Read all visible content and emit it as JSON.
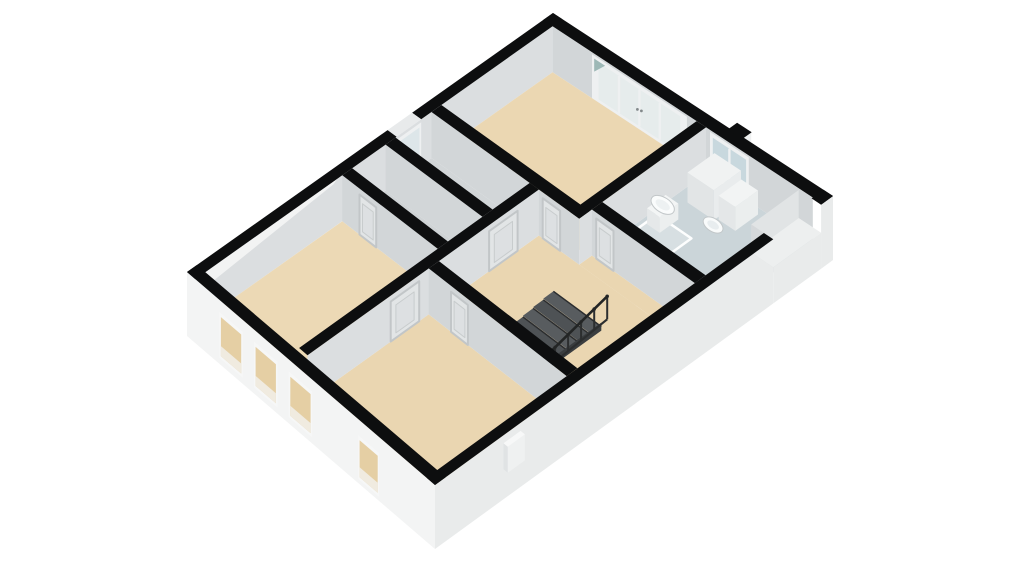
{
  "page": {
    "background": "#ffffff"
  },
  "scene": {
    "description_name": "3d-floorplan-upper-floor",
    "projection": {
      "n": [
        553,
        13
      ],
      "e": [
        833,
        196
      ],
      "s": [
        435,
        485
      ],
      "w": [
        187,
        272
      ]
    },
    "palette": {
      "wall_top": "#0d0e0f",
      "floor_beige": "#ebd7b2",
      "floor_gray": "#d2d6d8",
      "bath_floor": "#cbd5d9",
      "facade_white": "#f3f4f4",
      "facade_shade": "#e9ebeb",
      "face_sw": "#d2d6d8",
      "face_se": "#dbdee0",
      "glass_blue": "#c8d8de",
      "window_beige": "#e5cfa4"
    },
    "elements": [
      {
        "t": "face",
        "name": "ne-wall-interior-face",
        "a": [
          0.034,
          0.027
        ],
        "b": [
          0.966,
          0.027
        ],
        "top": 0,
        "bot": 46,
        "fill": "#d2d6d8"
      },
      {
        "t": "win",
        "name": "bedroom-a-french-doors",
        "a": [
          0.175,
          0.027
        ],
        "b": [
          0.515,
          0.027
        ],
        "top": 2,
        "bot": 46,
        "frame": "#eef0f1",
        "glass": "#e6ecec",
        "panels": 4,
        "handles": true
      },
      {
        "t": "poly",
        "name": "door-glass-reflection",
        "pts": [
          [
            0.183,
            0.027,
            5
          ],
          [
            0.222,
            0.027,
            5
          ],
          [
            0.183,
            0.027,
            18
          ]
        ],
        "fill": "#9db8b6"
      },
      {
        "t": "win",
        "name": "bathroom-window",
        "a": [
          0.598,
          0.027
        ],
        "b": [
          0.737,
          0.027
        ],
        "top": 2,
        "bot": 46,
        "frame": "#eef0f1",
        "glass": "#c8d8de",
        "panels": 2
      },
      {
        "t": "face",
        "name": "nw-wall-interior-face",
        "a": [
          0.034,
          0.027
        ],
        "b": [
          0.034,
          0.973
        ],
        "top": 0,
        "bot": 46,
        "fill": "#dbdee0"
      },
      {
        "t": "win",
        "name": "closet-window",
        "a": [
          0.034,
          0.385
        ],
        "b": [
          0.034,
          0.452
        ],
        "top": 3,
        "bot": 42,
        "frame": "#eef0f1",
        "glass": "#dde6e9",
        "panels": 1
      },
      {
        "t": "floor",
        "name": "bedroom-a-floor",
        "r": [
          0.034,
          0.027,
          0.55,
          0.33
        ],
        "drop": 46,
        "fill": "#ebd7b2"
      },
      {
        "t": "floor",
        "name": "bathroom-floor",
        "r": [
          0.584,
          0.027,
          0.966,
          0.297
        ],
        "drop": 46,
        "fill": "#cbd5d9"
      },
      {
        "t": "panel",
        "name": "shower-area",
        "r": [
          0.602,
          0.168,
          0.728,
          0.284
        ],
        "drop": 45,
        "fill": "#d7dfe2",
        "stroke": "#fdfefe",
        "sw": 2.5
      },
      {
        "t": "floor",
        "name": "closet-1-floor",
        "r": [
          0.034,
          0.357,
          0.4,
          0.455
        ],
        "drop": 46,
        "fill": "#d2d6d8"
      },
      {
        "t": "floor",
        "name": "closet-2-floor",
        "r": [
          0.034,
          0.482,
          0.4,
          0.573
        ],
        "drop": 46,
        "fill": "#cfd3d5"
      },
      {
        "t": "floor",
        "name": "hallway-floor",
        "r": [
          0.434,
          0.357,
          0.966,
          0.62
        ],
        "drop": 46,
        "fill": "#ead6b1"
      },
      {
        "t": "floor",
        "name": "hallway-floor-annex",
        "r": [
          0.584,
          0.324,
          0.966,
          0.357
        ],
        "drop": 46,
        "fill": "#ead6b1"
      },
      {
        "t": "floor",
        "name": "bedroom-b-floor",
        "r": [
          0.034,
          0.6,
          0.4,
          0.966
        ],
        "drop": 46,
        "fill": "#ecd9b5"
      },
      {
        "t": "floor",
        "name": "bedroom-c-floor",
        "r": [
          0.434,
          0.647,
          0.966,
          0.966
        ],
        "drop": 46,
        "fill": "#ead6b1"
      },
      {
        "t": "face",
        "name": "bathroom-west-wall-face",
        "a": [
          0.584,
          0.027
        ],
        "b": [
          0.584,
          0.357
        ],
        "top": 0,
        "bot": 46,
        "fill": "#dbdee0"
      },
      {
        "t": "prism",
        "name": "bathroom-cabinet",
        "r": [
          0.625,
          0.035,
          0.72,
          0.105
        ],
        "top": 16,
        "bot": 46,
        "topFill": "#f0f2f2",
        "vFill": "#e2e5e6",
        "uFill": "#e9eced"
      },
      {
        "t": "prism",
        "name": "sink-pedestal",
        "r": [
          0.606,
          0.148,
          0.652,
          0.196
        ],
        "top": 30,
        "bot": 46,
        "topFill": "#f3f5f5",
        "vFill": "#e5e8e9",
        "uFill": "#ecefef"
      },
      {
        "t": "ell",
        "name": "sink-basin",
        "c": [
          0.629,
          0.172,
          29
        ],
        "rx": 13,
        "ry": 7.5,
        "rot": 33,
        "fill": "#fafcfc",
        "stroke": "#c2c7c9",
        "sw": 1,
        "irx": 8,
        "iry": 4.2,
        "ifill": "#edf1f2"
      },
      {
        "t": "prism",
        "name": "toilet-cistern",
        "r": [
          0.728,
          0.04,
          0.788,
          0.098
        ],
        "top": 22,
        "bot": 46,
        "topFill": "#f2f4f4",
        "vFill": "#e4e7e8",
        "uFill": "#ebeeee"
      },
      {
        "t": "ell",
        "name": "toilet-bowl",
        "c": [
          0.757,
          0.133,
          36
        ],
        "rx": 11,
        "ry": 6.5,
        "rot": 33,
        "fill": "#f9fbfb",
        "stroke": "#c2c7c9",
        "sw": 1,
        "irx": 6.5,
        "iry": 3.6,
        "ifill": "#e8edef"
      },
      {
        "t": "face",
        "name": "bathroom-hall-wall-face",
        "a": [
          0.584,
          0.324
        ],
        "b": [
          0.966,
          0.324
        ],
        "top": 0,
        "bot": 46,
        "fill": "#d2d6d8"
      },
      {
        "t": "door",
        "name": "bathroom-door",
        "a": [
          0.6,
          0.324
        ],
        "b": [
          0.664,
          0.324
        ],
        "top": 6,
        "bot": 46
      },
      {
        "t": "face",
        "name": "bedroom-a-south-wall-face",
        "a": [
          0.034,
          0.357
        ],
        "b": [
          0.584,
          0.357
        ],
        "top": 0,
        "bot": 46,
        "fill": "#d2d6d8"
      },
      {
        "t": "door",
        "name": "bedroom-a-door",
        "a": [
          0.448,
          0.357
        ],
        "b": [
          0.513,
          0.357
        ],
        "top": 6,
        "bot": 46
      },
      {
        "t": "face",
        "name": "closet-divider-face",
        "a": [
          0.034,
          0.482
        ],
        "b": [
          0.4,
          0.482
        ],
        "top": 0,
        "bot": 46,
        "fill": "#d2d6d8"
      },
      {
        "t": "face",
        "name": "closet-south-wall-face",
        "a": [
          0.034,
          0.6
        ],
        "b": [
          0.4,
          0.6
        ],
        "top": 0,
        "bot": 46,
        "fill": "#d2d6d8"
      },
      {
        "t": "door",
        "name": "closet-2-door",
        "a": [
          0.1,
          0.6
        ],
        "b": [
          0.164,
          0.6
        ],
        "top": 6,
        "bot": 46
      },
      {
        "t": "face",
        "name": "central-wall-face",
        "a": [
          0.434,
          0.357
        ],
        "b": [
          0.434,
          0.966
        ],
        "top": 0,
        "bot": 46,
        "fill": "#dbdee0"
      },
      {
        "t": "door",
        "name": "closet-hall-door",
        "a": [
          0.434,
          0.413
        ],
        "b": [
          0.434,
          0.488
        ],
        "top": 6,
        "bot": 46
      },
      {
        "t": "door",
        "name": "bedroom-b-door",
        "a": [
          0.434,
          0.672
        ],
        "b": [
          0.434,
          0.747
        ],
        "top": 6,
        "bot": 46
      },
      {
        "t": "stairs",
        "name": "staircase",
        "r": [
          0.6,
          0.435,
          0.78,
          0.62
        ],
        "steps": 7
      },
      {
        "t": "railing",
        "name": "stair-railing",
        "u": 0.78,
        "v0": 0.42,
        "v1": 0.62,
        "posts": 7
      },
      {
        "t": "face",
        "name": "bedroom-c-north-wall-face",
        "a": [
          0.434,
          0.647
        ],
        "b": [
          0.966,
          0.647
        ],
        "top": 0,
        "bot": 46,
        "fill": "#d2d6d8"
      },
      {
        "t": "door",
        "name": "bedroom-c-door",
        "a": [
          0.52,
          0.647
        ],
        "b": [
          0.585,
          0.647
        ],
        "top": 6,
        "bot": 46
      },
      {
        "t": "poly",
        "name": "west-corner-wall-sliver",
        "pts": [
          [
            0,
            0.55,
            3
          ],
          [
            0,
            1,
            2
          ],
          [
            0,
            1,
            30
          ],
          [
            0,
            0.6,
            16
          ]
        ],
        "fill": "#f2f3f3"
      },
      {
        "t": "face",
        "name": "southwest-facade",
        "a": [
          0,
          1
        ],
        "b": [
          1,
          1
        ],
        "top": 0,
        "bot": 64,
        "fill": "#f3f4f4"
      },
      {
        "t": "win",
        "name": "facade-window-1",
        "a": [
          0.13,
          1
        ],
        "b": [
          0.225,
          1
        ],
        "top": 12,
        "bot": 58,
        "frame": "#f6f7f7",
        "glass": "#e5cfa4",
        "panels": 1,
        "lower": true
      },
      {
        "t": "win",
        "name": "facade-window-2",
        "a": [
          0.27,
          1
        ],
        "b": [
          0.365,
          1
        ],
        "top": 12,
        "bot": 58,
        "frame": "#f6f7f7",
        "glass": "#e5cfa4",
        "panels": 1,
        "lower": true
      },
      {
        "t": "win",
        "name": "facade-window-3",
        "a": [
          0.41,
          1
        ],
        "b": [
          0.505,
          1
        ],
        "top": 12,
        "bot": 58,
        "frame": "#f6f7f7",
        "glass": "#e5cfa4",
        "panels": 1,
        "lower": true
      },
      {
        "t": "win",
        "name": "facade-window-4",
        "a": [
          0.69,
          1
        ],
        "b": [
          0.775,
          1
        ],
        "top": 16,
        "bot": 60,
        "frame": "#f6f7f7",
        "glass": "#e5cfa4",
        "panels": 1,
        "lower": true
      },
      {
        "t": "face",
        "name": "southeast-facade",
        "a": [
          1,
          0.15
        ],
        "b": [
          1,
          1
        ],
        "top": 0,
        "bot": 64,
        "fill": "#e9ebeb"
      },
      {
        "t": "face",
        "name": "southeast-facade-tip",
        "a": [
          1,
          0
        ],
        "b": [
          1,
          0.03
        ],
        "top": 0,
        "bot": 64,
        "fill": "#e9ebeb"
      },
      {
        "t": "face",
        "name": "alcove-inner-face",
        "a": [
          0.92,
          0.03
        ],
        "b": [
          0.92,
          0.15
        ],
        "top": 0,
        "bot": 28,
        "fill": "#e1e4e5"
      },
      {
        "t": "face",
        "name": "alcove-side-face",
        "a": [
          0.92,
          0.15
        ],
        "b": [
          1,
          0.15
        ],
        "top": 0,
        "bot": 28,
        "fill": "#d5d8da"
      },
      {
        "t": "floor",
        "name": "alcove-floor",
        "r": [
          0.92,
          0.03,
          1,
          0.15
        ],
        "drop": 28,
        "fill": "#edefef"
      },
      {
        "t": "face",
        "name": "alcove-lower-facade",
        "a": [
          1,
          0.03
        ],
        "b": [
          1,
          0.15
        ],
        "top": 28,
        "bot": 64,
        "fill": "#e9ebeb"
      },
      {
        "t": "prism",
        "name": "facade-vent",
        "r": [
          1.0,
          0.785,
          1.017,
          0.828
        ],
        "top": 8,
        "bot": 34,
        "topFill": "#f7f8f8",
        "vFill": "#e0e3e4",
        "uFill": "#eff1f1"
      },
      {
        "t": "face",
        "name": "chimney-side",
        "a": [
          0.68,
          -0.02
        ],
        "b": [
          0.68,
          0.002
        ],
        "top": 0,
        "bot": 12,
        "fill": "#eff1f1"
      },
      {
        "t": "top",
        "name": "nw-wall-top-a",
        "r": [
          0,
          0,
          0.034,
          0.385
        ],
        "fill": "#0d0e0f"
      },
      {
        "t": "top",
        "name": "nw-window-head",
        "r": [
          0,
          0.385,
          0.034,
          0.452
        ],
        "fill": "#e8eaeb"
      },
      {
        "t": "top",
        "name": "nw-wall-top-b",
        "r": [
          0,
          0.452,
          0.034,
          1
        ],
        "fill": "#0d0e0f"
      },
      {
        "t": "top",
        "name": "ne-wall-top",
        "r": [
          0,
          0,
          1,
          0.027
        ],
        "fill": "#0d0e0f"
      },
      {
        "t": "top",
        "name": "chimney-top",
        "r": [
          0.63,
          -0.02,
          0.682,
          0.004
        ],
        "fill": "#0d0e0f"
      },
      {
        "t": "top",
        "name": "se-wall-top-a",
        "r": [
          0.966,
          0,
          1,
          0.03
        ],
        "fill": "#0d0e0f"
      },
      {
        "t": "top",
        "name": "se-wall-top-b",
        "r": [
          0.966,
          0.15,
          1,
          1
        ],
        "fill": "#0d0e0f"
      },
      {
        "t": "top",
        "name": "sw-wall-top",
        "r": [
          0,
          0.973,
          1,
          1
        ],
        "fill": "#0d0e0f"
      },
      {
        "t": "top",
        "name": "bathroom-west-wall-top",
        "r": [
          0.55,
          0.027,
          0.584,
          0.357
        ],
        "fill": "#0d0e0f"
      },
      {
        "t": "top",
        "name": "bedroom-a-south-wall-top",
        "r": [
          0.034,
          0.33,
          0.584,
          0.357
        ],
        "fill": "#0d0e0f"
      },
      {
        "t": "top",
        "name": "closet-divider-top",
        "r": [
          0.034,
          0.455,
          0.4,
          0.482
        ],
        "fill": "#0d0e0f"
      },
      {
        "t": "top",
        "name": "central-wall-top",
        "r": [
          0.4,
          0.357,
          0.434,
          0.966
        ],
        "fill": "#0d0e0f"
      },
      {
        "t": "top",
        "name": "closet-south-wall-top",
        "r": [
          0.034,
          0.573,
          0.4,
          0.6
        ],
        "fill": "#0d0e0f"
      },
      {
        "t": "top",
        "name": "bathroom-hall-wall-top",
        "r": [
          0.584,
          0.297,
          0.966,
          0.324
        ],
        "fill": "#0d0e0f"
      },
      {
        "t": "top",
        "name": "bedroom-c-north-wall-top",
        "r": [
          0.434,
          0.62,
          0.966,
          0.647
        ],
        "fill": "#0d0e0f"
      }
    ]
  }
}
